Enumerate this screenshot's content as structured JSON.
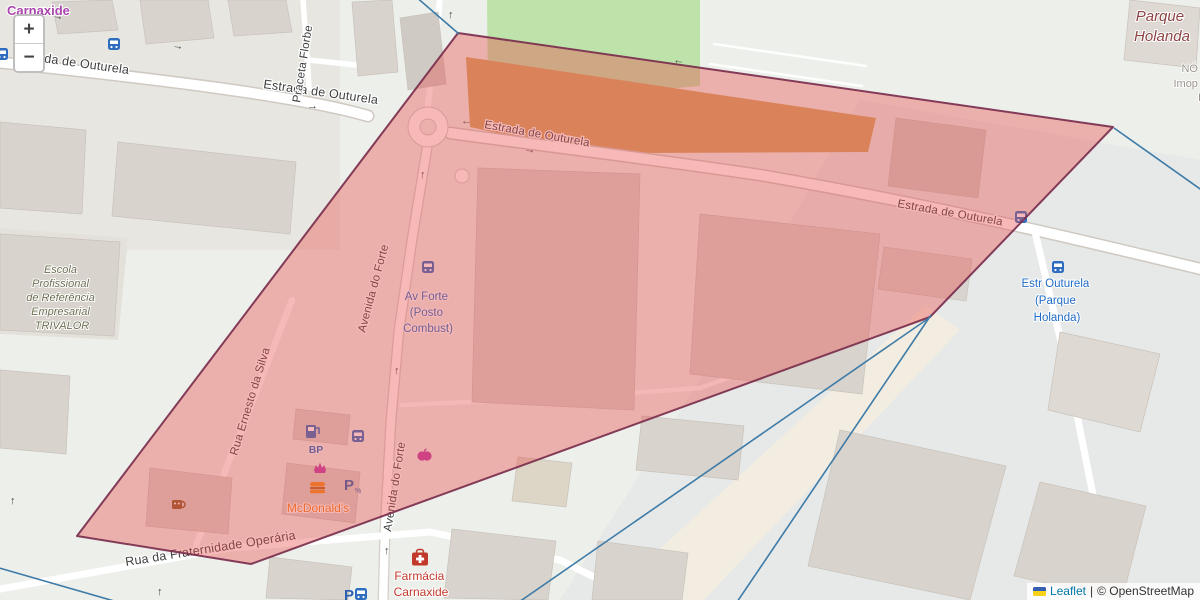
{
  "controls": {
    "zoom_in_label": "+",
    "zoom_out_label": "−"
  },
  "attribution": {
    "leaflet_link": "Leaflet",
    "separator": "|",
    "copyright": "© OpenStreetMap"
  },
  "street_labels": {
    "estrada": "Estrada de Outurela",
    "praceta": "Praceta Florbe",
    "avenida": "Avenida do Forte",
    "ernesto": "Rua Ernesto da Silva",
    "fraternidade": "Rua da Fraternidade Operária"
  },
  "place_labels": {
    "town": "Carnaxide",
    "suburb_lines": [
      "Parque",
      "Holanda"
    ],
    "partial_lines": [
      "NÓ",
      "Imop",
      "I"
    ]
  },
  "poi_labels": {
    "school_lines": [
      "Escola",
      "Profissional",
      "de Referência",
      "Empresarial",
      "TRIVALOR"
    ],
    "bus_av_forte_lines": [
      "Av Forte",
      "(Posto",
      "Combust)"
    ],
    "bus_estr_outurela_lines": [
      "Estr Outurela",
      "(Parque",
      "Holanda)"
    ],
    "mcdonalds": "McDonald's",
    "fuel_brand": "BP",
    "pharmacy_lines": [
      "Farmácia",
      "Carnaxide"
    ]
  },
  "glyphs": {
    "arrow_up": "↑",
    "arrow_left": "←",
    "arrow_right": "→",
    "parking": "P",
    "parking_note": "%"
  },
  "colors": {
    "overlay_fill": "#e8504d",
    "overlay_border": "#7a2e4d",
    "boundary_line": "#3e7ba8",
    "bus_label_blue": "#1f6ac4",
    "pharmacy_red": "#c0392b",
    "mcdonalds_orange": "#ef7f1a",
    "school_olive": "#6e6e52",
    "suburb_maroon": "#8d4343",
    "town_purple": "#a945ad",
    "park_green": "#bde3aa",
    "brownfield_tan": "#d0a565",
    "building_gray": "#d8d4cd"
  }
}
